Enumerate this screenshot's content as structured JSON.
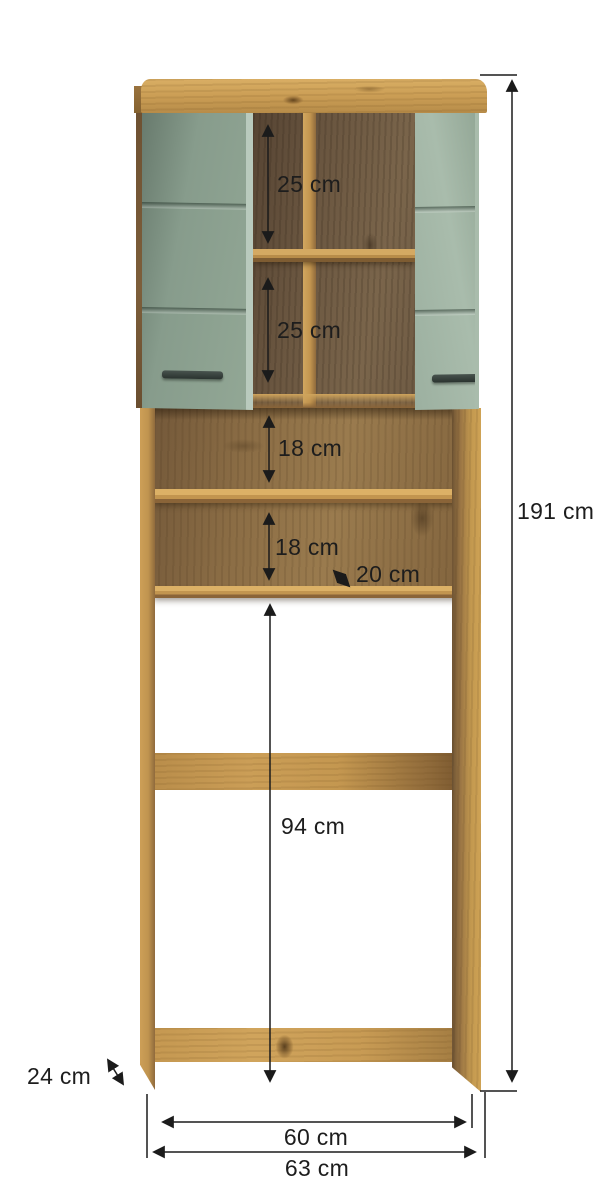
{
  "diagram": {
    "subject": "tall wood cabinet with two sage-green doors, open shelves and floor-stand frame",
    "unit": "cm"
  },
  "dimensions": {
    "overall_height": "191 cm",
    "top_compartment_upper": "25 cm",
    "top_compartment_lower": "25 cm",
    "open_shelf_upper": "18 cm",
    "open_shelf_lower": "18 cm",
    "shelf_depth": "20 cm",
    "clearance_height": "94 cm",
    "side_depth": "24 cm",
    "inner_width": "60 cm",
    "outer_width": "63 cm"
  },
  "colors": {
    "wood": "#c99c54",
    "wood_shadow": "#8a6438",
    "interior_back": "#6a5640",
    "door_green": "#8fa494",
    "door_edge": "#b9cabd",
    "handle": "#2f3a36",
    "dimension_line": "#1b1b1b",
    "background": "#ffffff"
  }
}
